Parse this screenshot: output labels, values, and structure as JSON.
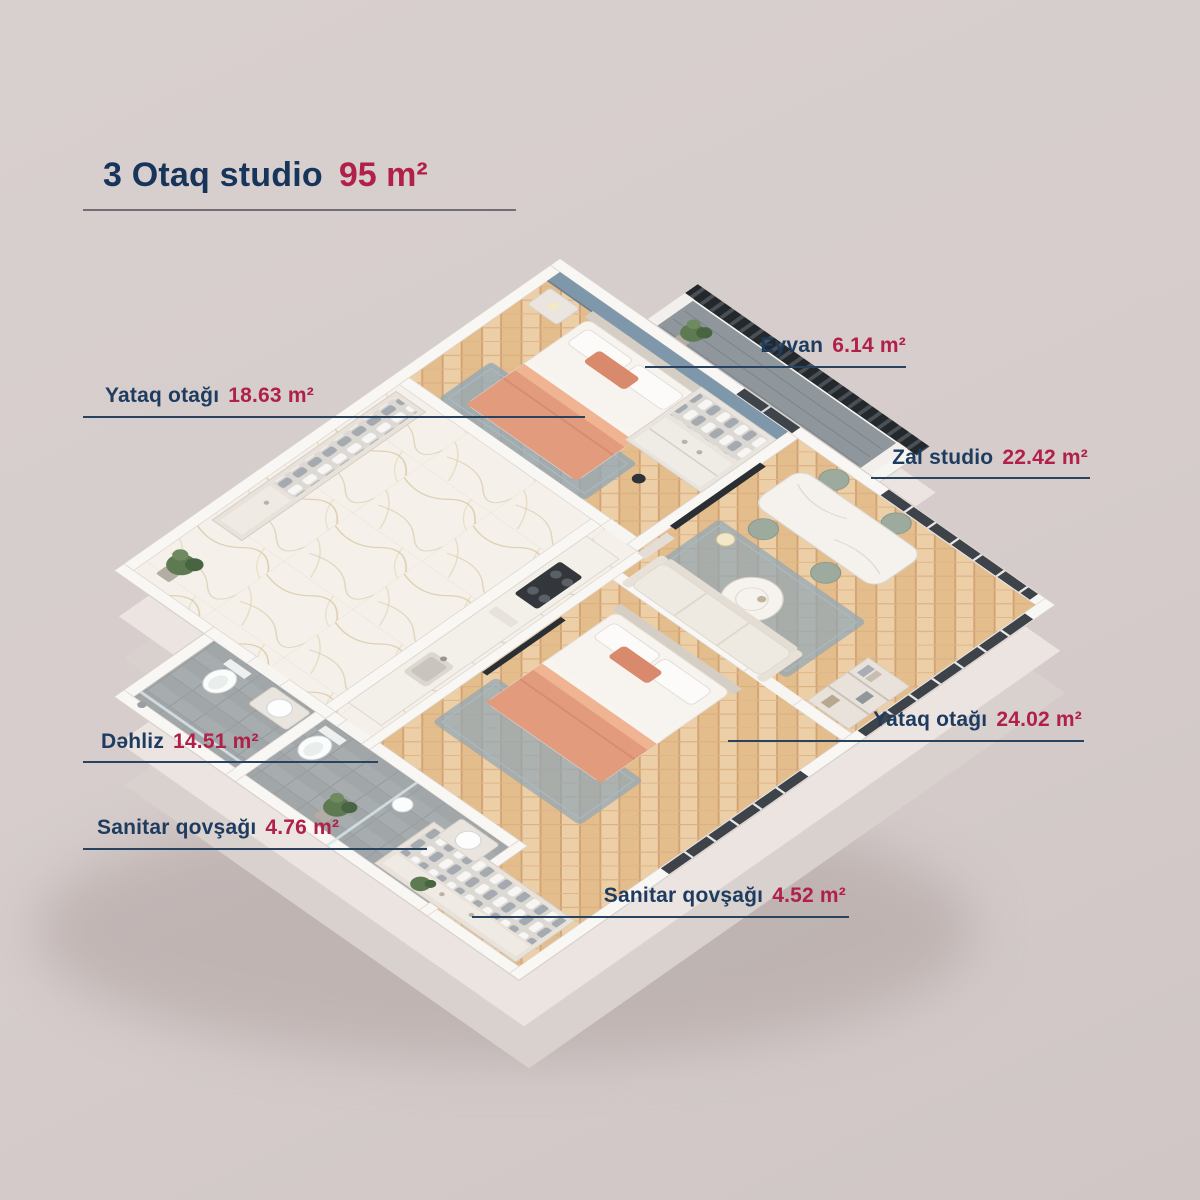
{
  "title": {
    "name": "3 Otaq studio",
    "area": "95",
    "unit": "m²"
  },
  "labels": [
    {
      "id": "eyvan",
      "name": "Eyvan",
      "area": "6.14",
      "unit": "m²"
    },
    {
      "id": "yataq-1",
      "name": "Yataq otağı",
      "area": "18.63",
      "unit": "m²"
    },
    {
      "id": "zal",
      "name": "Zal studio",
      "area": "22.42",
      "unit": "m²"
    },
    {
      "id": "yataq-2",
      "name": "Yataq otağı",
      "area": "24.02",
      "unit": "m²"
    },
    {
      "id": "dehliz",
      "name": "Dəhliz",
      "area": "14.51",
      "unit": "m²"
    },
    {
      "id": "sanitar-1",
      "name": "Sanitar qovşağı",
      "area": "4.76",
      "unit": "m²"
    },
    {
      "id": "sanitar-2",
      "name": "Sanitar qovşağı",
      "area": "4.52",
      "unit": "m²"
    }
  ],
  "colors": {
    "background": "#d5cccb",
    "text_primary": "#17345a",
    "text_accent": "#b02048",
    "leader_line": "#27435f",
    "wall": "#f9f7f4",
    "floor_wood": "#eccfa6",
    "floor_marble": "#f5f1ea",
    "floor_tile": "#a7acae",
    "rug": "#92a6b4",
    "bedding_accent": "#d98a6c",
    "railing": "#2f3438"
  }
}
